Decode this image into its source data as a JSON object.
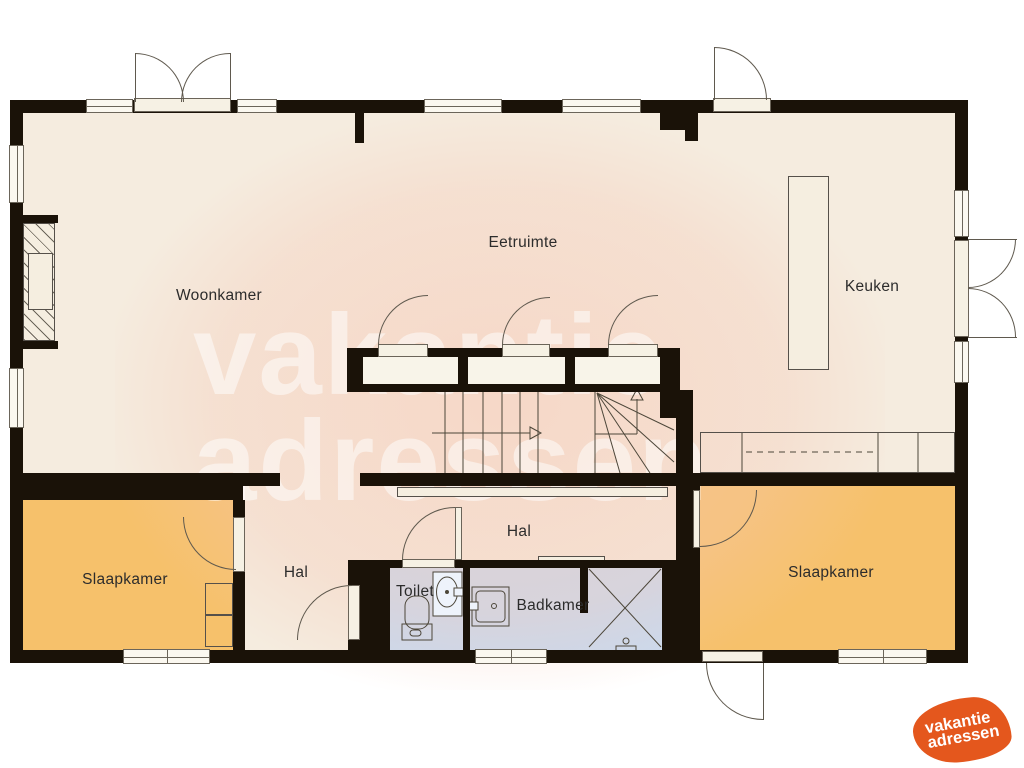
{
  "labels": {
    "woonkamer": "Woonkamer",
    "eetruimte": "Eetruimte",
    "keuken": "Keuken",
    "hal_main": "Hal",
    "hal_small": "Hal",
    "slaapkamer_left": "Slaapkamer",
    "slaapkamer_right": "Slaapkamer",
    "toilet": "Toilet",
    "badkamer": "Badkamer"
  },
  "watermark": {
    "line1": "vakantie",
    "line2": "adressen"
  },
  "logo": {
    "line1": "vakantie",
    "line2": "adressen"
  },
  "colors": {
    "wall": "#1a1208",
    "floor": "#f5ecdf",
    "bedroom": "#f6c16b",
    "bathroom": "#c8daf0",
    "window": "#fbf8f0",
    "accent": "#e4571d",
    "highlight": "#f6c7b4",
    "line": "#55504a",
    "text": "#2c2c2c"
  }
}
